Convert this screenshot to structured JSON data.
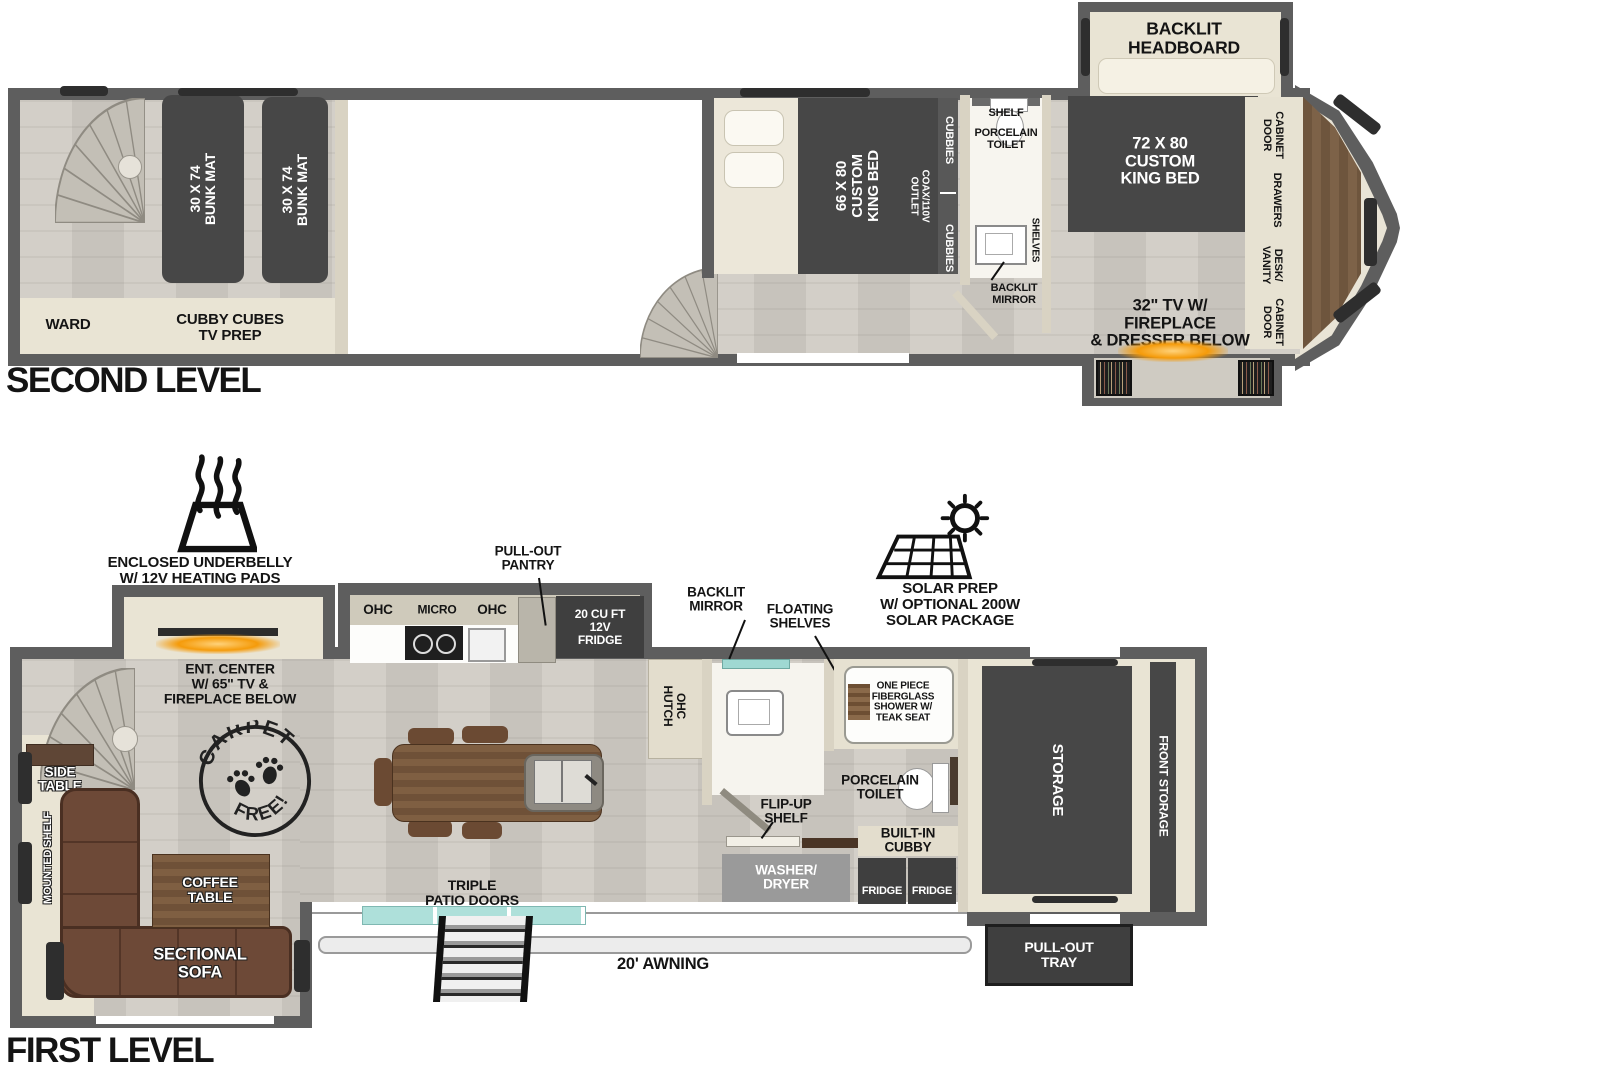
{
  "colors": {
    "wall": "#5e5e5e",
    "floor": "#cdc9c1",
    "beige_interior": "#e9e4d4",
    "dark_furniture": "#474747",
    "sofa_brown": "#6d4937",
    "wood_brown": "#7a5a3e",
    "door_teal": "#aee0da",
    "fireplace_glow": "#f59b0a"
  },
  "second": {
    "title": "SECOND LEVEL",
    "ward": "WARD",
    "cubby_cubes": "CUBBY CUBES\nTV PREP",
    "bunk_mat_1": "30 X 74\nBUNK MAT",
    "bunk_mat_2": "30 X 74\nBUNK MAT",
    "king_bed": "66 X 80\nCUSTOM\nKING BED",
    "cubbies_top": "CUBBIES",
    "coax_outlet": "COAX/110V\nOUTLET",
    "cubbies_bottom": "CUBBIES",
    "shelf": "SHELF",
    "porcelain_toilet": "PORCELAIN\nTOILET",
    "shelves": "SHELVES",
    "backlit_mirror": "BACKLIT\nMIRROR",
    "backlit_headboard": "BACKLIT\nHEADBOARD",
    "master_bed": "72 X  80\nCUSTOM\nKING BED",
    "cabinet_door_top": "CABINET\nDOOR",
    "drawers": "DRAWERS",
    "desk_vanity": "DESK/\nVANITY",
    "cabinet_door_bottom": "CABINET\nDOOR",
    "tv_fireplace": "32\" TV W/\nFIREPLACE\n& DRESSER BELOW"
  },
  "first": {
    "title": "FIRST LEVEL",
    "underbelly": "ENCLOSED UNDERBELLY\nW/ 12V HEATING PADS",
    "ent_center": "ENT. CENTER\nW/ 65\" TV &\nFIREPLACE BELOW",
    "ohc_left": "OHC",
    "micro": "MICRO",
    "ohc_right": "OHC",
    "pullout_pantry": "PULL-OUT\nPANTRY",
    "fridge_12v": "20 CU FT\n12V\nFRIDGE",
    "ohc_hutch": "OHC\nHUTCH",
    "backlit_mirror": "BACKLIT\nMIRROR",
    "floating_shelves": "FLOATING\nSHELVES",
    "solar_prep": "SOLAR PREP\nW/ OPTIONAL 200W\nSOLAR PACKAGE",
    "shower": "ONE PIECE\nFIBERGLASS\nSHOWER W/\nTEAK SEAT",
    "porcelain_toilet": "PORCELAIN\nTOILET",
    "flip_up_shelf": "FLIP-UP\nSHELF",
    "built_in_cubby": "BUILT-IN\nCUBBY",
    "washer_dryer": "WASHER/\nDRYER",
    "fridge_left": "FRIDGE",
    "fridge_right": "FRIDGE",
    "storage": "STORAGE",
    "front_storage": "FRONT STORAGE",
    "pull_out_tray": "PULL-OUT\nTRAY",
    "side_table": "SIDE\nTABLE",
    "mounted_shelf": "MOUNTED SHELF",
    "coffee_table": "COFFEE\nTABLE",
    "sectional_sofa": "SECTIONAL\nSOFA",
    "carpet_stamp_top": "CARPET",
    "carpet_stamp_bottom": "FREE!",
    "triple_patio_doors": "TRIPLE\nPATIO DOORS",
    "awning": "20' AWNING"
  }
}
